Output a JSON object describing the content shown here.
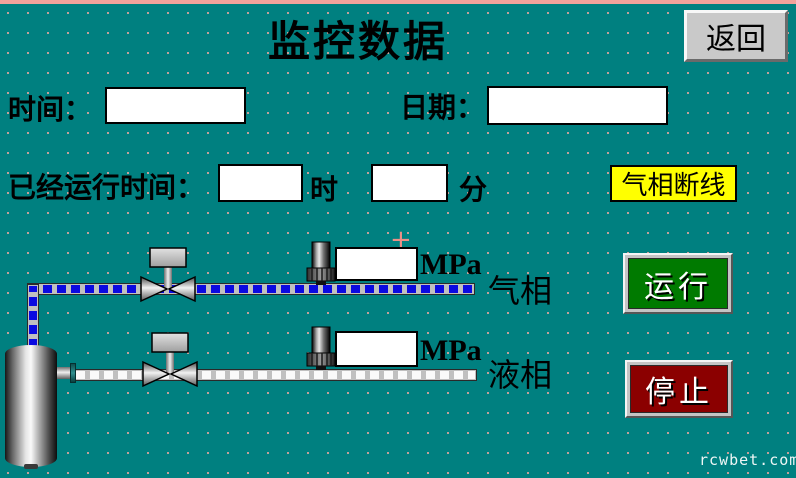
{
  "window": {
    "title": "监控数据",
    "watermark": "rcwbet.com"
  },
  "header": {
    "back_label": "返回"
  },
  "info": {
    "time_label": "时间：",
    "time_value": "",
    "date_label": "日期：",
    "date_value": "",
    "runtime_label": "已经运行时间：",
    "runtime_hours_value": "",
    "runtime_hours_unit": "时",
    "runtime_minutes_value": "",
    "runtime_minutes_unit": "分"
  },
  "alarm": {
    "text": "气相断线"
  },
  "lines": {
    "gas": {
      "name": "气相",
      "pressure_value": "",
      "pressure_unit": "MPa"
    },
    "liquid": {
      "name": "液相",
      "pressure_value": "",
      "pressure_unit": "MPa"
    }
  },
  "controls": {
    "run_label": "运行",
    "stop_label": "停止"
  },
  "markers": {
    "cross": "+"
  },
  "colors": {
    "background": "#008080",
    "grid_dot": "#f2a9a0",
    "top_band": "#f2a29b",
    "gas_pipe_dash": "#0a0ae0",
    "liquid_pipe_dash": "#fafafa",
    "alarm_bg": "#ffff00",
    "run_button_bg": "#007a00",
    "stop_button_bg": "#8b0000",
    "button_face": "#c9c9c9"
  }
}
